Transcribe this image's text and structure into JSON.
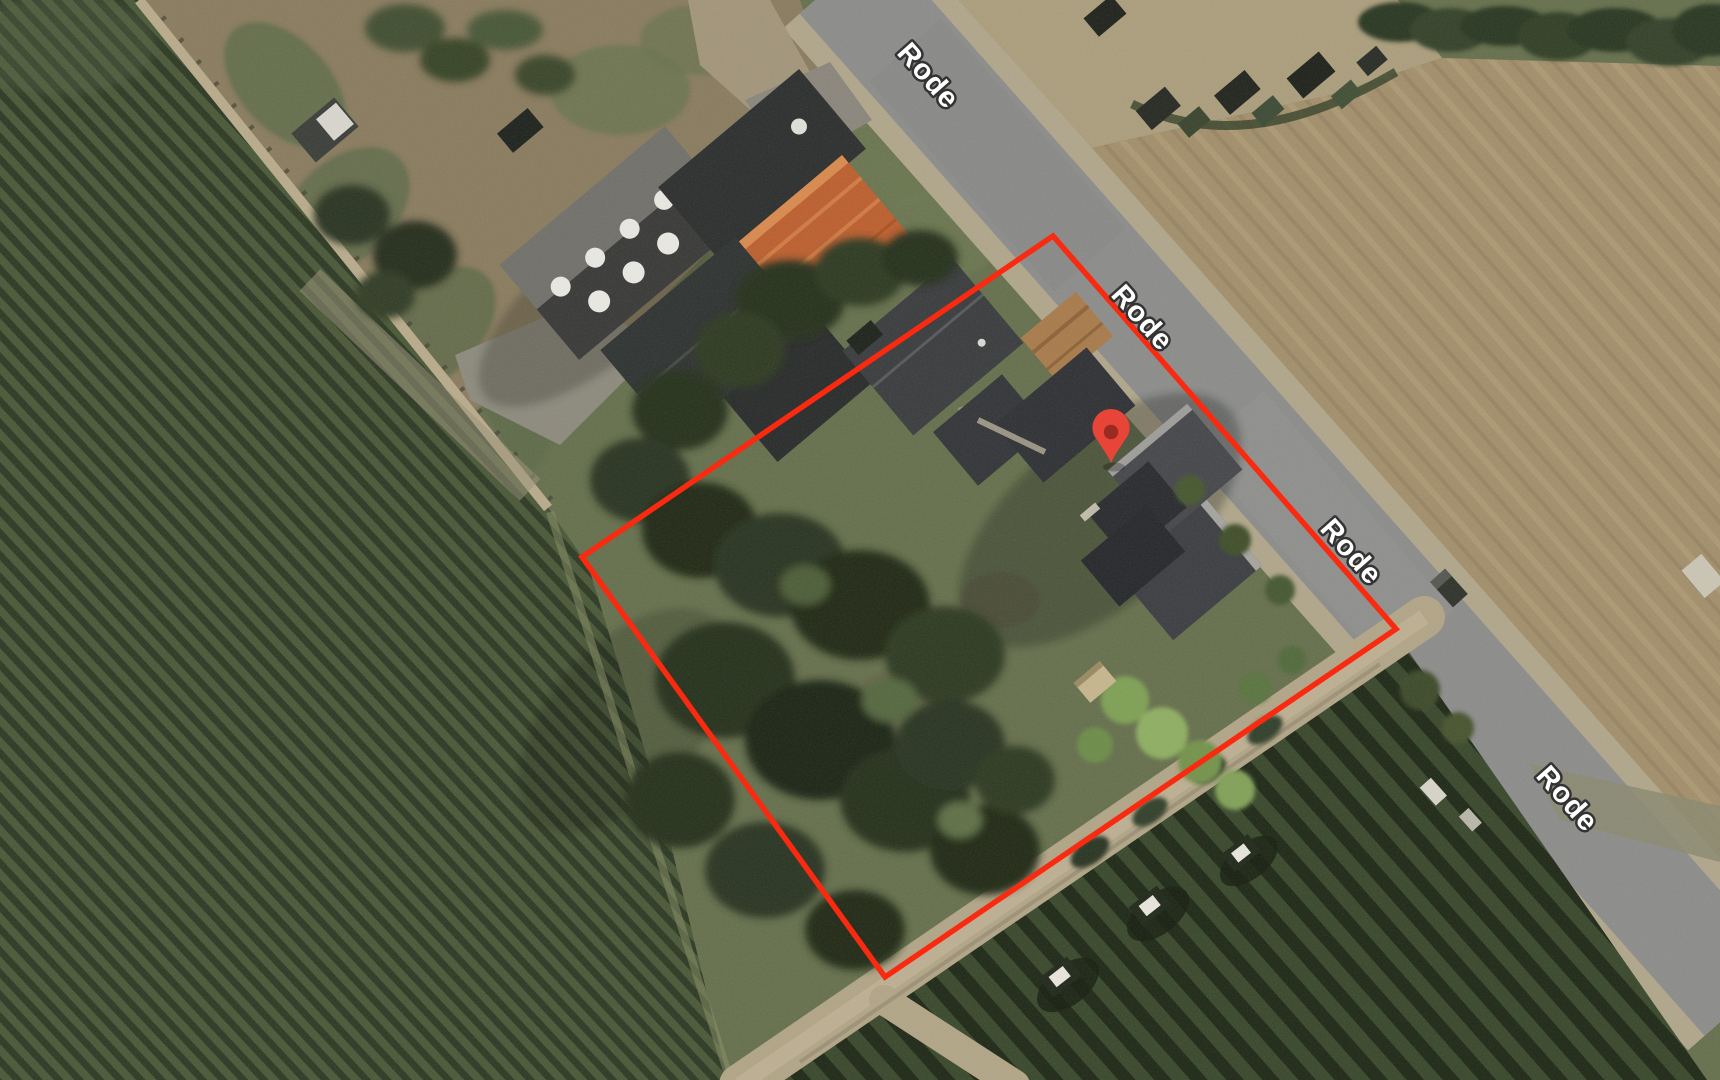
{
  "app": {
    "name": "satellite-map-view",
    "view_mode": "satellite"
  },
  "road_labels": [
    {
      "text": "Rode",
      "x": 927,
      "y": 77,
      "rotation": 48.5
    },
    {
      "text": "Rode",
      "x": 1141,
      "y": 319,
      "rotation": 48.5
    },
    {
      "text": "Rode",
      "x": 1350,
      "y": 553,
      "rotation": 48.5
    },
    {
      "text": "Rode",
      "x": 1566,
      "y": 800,
      "rotation": 48.5
    }
  ],
  "label_style": {
    "fill": "#ffffff",
    "halo": "#333333"
  },
  "parcel_boundary": {
    "color": "#f92a10",
    "stroke_width": 5.5,
    "points": [
      [
        1053,
        236
      ],
      [
        1396,
        629
      ],
      [
        885,
        977
      ],
      [
        582,
        557
      ]
    ]
  },
  "marker": {
    "x": 1111,
    "y": 463,
    "color": "#e84437",
    "dot_color": "#9b2a21"
  },
  "palette": {
    "road_asphalt": "#8c8c8a",
    "road_shoulder": "#b0a68b",
    "field_brown": "#a28f6b",
    "parking_gravel": "#ab9e7d",
    "vineyard_dark": "#2e3a24",
    "vineyard_light": "#4a5938",
    "tree_dark": "#26301c",
    "grass": "#66704d",
    "roof_dark": "#35373a",
    "roof_orange": "#bc5f2f"
  }
}
